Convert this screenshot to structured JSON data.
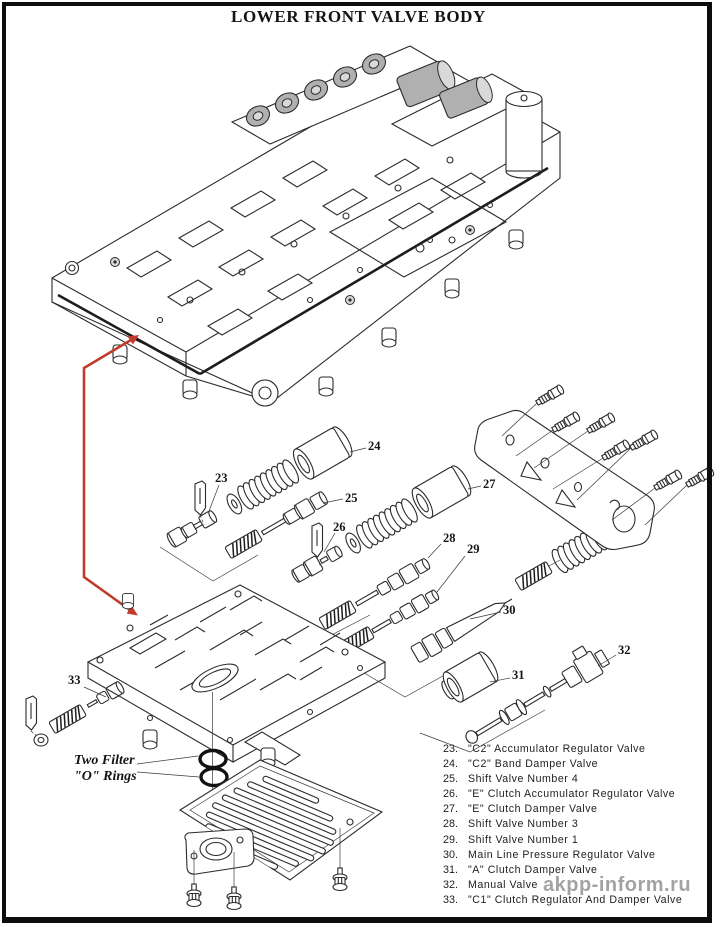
{
  "page": {
    "title": "LOWER FRONT VALVE BODY",
    "watermark": "akpp-inform.ru"
  },
  "annotation": {
    "filter_orings_line1": "Two Filter",
    "filter_orings_line2": "\"O\" Rings"
  },
  "colors": {
    "arrow_red": "#c23a2c",
    "solenoid_gray": "#b0b0b0",
    "watermark_gray": "#9c9c9c",
    "line": "#2b2b2b"
  },
  "callouts": [
    {
      "num": "23"
    },
    {
      "num": "24"
    },
    {
      "num": "25"
    },
    {
      "num": "26"
    },
    {
      "num": "27"
    },
    {
      "num": "28"
    },
    {
      "num": "29"
    },
    {
      "num": "30"
    },
    {
      "num": "31"
    },
    {
      "num": "32"
    },
    {
      "num": "33"
    }
  ],
  "parts_list": [
    {
      "num": "23.",
      "name": "\"C2\" Accumulator Regulator Valve"
    },
    {
      "num": "24.",
      "name": "\"C2\" Band Damper Valve"
    },
    {
      "num": "25.",
      "name": "Shift Valve Number 4"
    },
    {
      "num": "26.",
      "name": "\"E\" Clutch Accumulator Regulator Valve"
    },
    {
      "num": "27.",
      "name": "\"E\" Clutch Damper Valve"
    },
    {
      "num": "28.",
      "name": "Shift Valve Number 3"
    },
    {
      "num": "29.",
      "name": "Shift Valve Number 1"
    },
    {
      "num": "30.",
      "name": "Main Line Pressure Regulator Valve"
    },
    {
      "num": "31.",
      "name": "\"A\" Clutch Damper Valve"
    },
    {
      "num": "32.",
      "name": "Manual Valve"
    },
    {
      "num": "33.",
      "name": "\"C1\" Clutch Regulator And Damper Valve"
    }
  ]
}
